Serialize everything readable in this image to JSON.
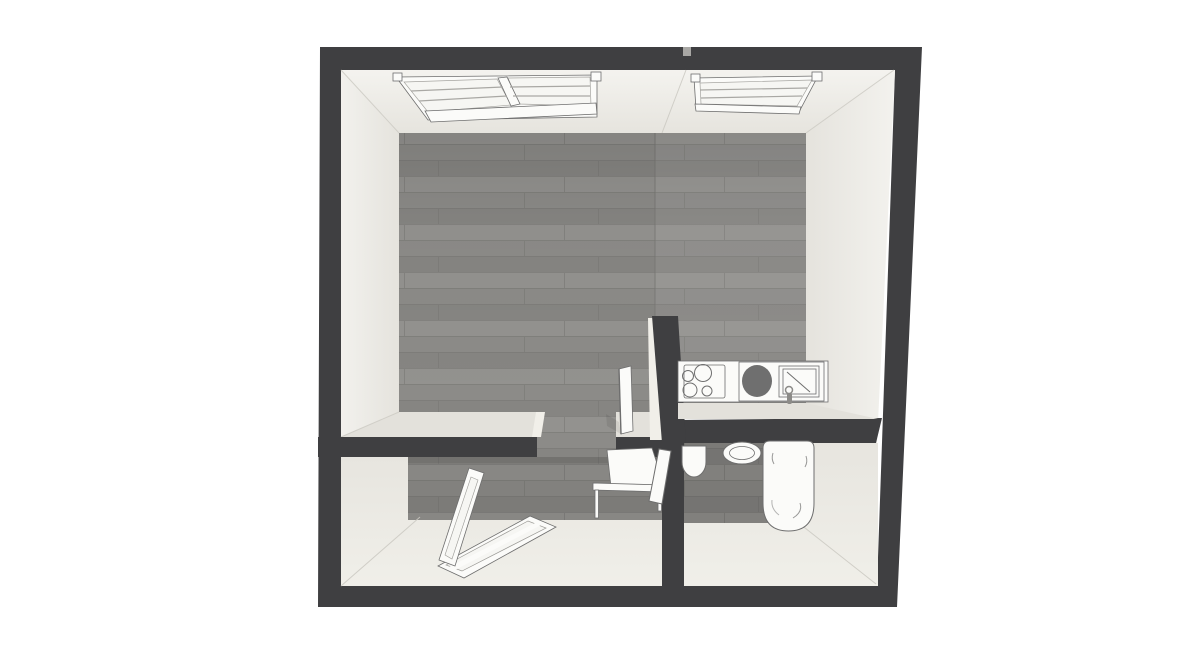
{
  "canvas": {
    "width": 1200,
    "height": 650,
    "view": "3d-floor-plan-top-down"
  },
  "page_background": "#ffffff",
  "colors": {
    "page_background": "#ffffff",
    "wall_top": "#3f3f41",
    "wall_face": "#f1efe9",
    "wall_face_shade": "#e3e1db",
    "floor_wood": "#8c8b88",
    "floor_wood_row2": "#868582",
    "floor_wood_row3": "#93928f",
    "plank_line": "#787774",
    "floor_soft": "#ecebe5",
    "fixture_fill": "#fbfbf9",
    "fixture_stroke": "#6e6e6e",
    "basin_fill": "#6f6f6f",
    "glass_fill": "#f6f6f3",
    "seam": "#cbc9c2",
    "notch": "#a8a7a4",
    "metal": "#8c8b88"
  },
  "scene": {
    "description_tag": "apartment-floorplan-render",
    "rooms": [
      {
        "name": "main-room",
        "floor": "wood-planks",
        "fixtures": [
          "roof-window-double",
          "roof-window-single",
          "interior-door-open"
        ]
      },
      {
        "name": "kitchen-nook",
        "floor": "wood-planks",
        "fixtures": [
          "kitchen-counter",
          "cooktop-4-burner",
          "kitchen-sink",
          "faucet"
        ]
      },
      {
        "name": "bottom-left-room",
        "floor": "wood-planks-partial",
        "fixtures": [
          "roof-window-open",
          "table",
          "bathroom-door-open"
        ]
      },
      {
        "name": "bathroom",
        "floor": "wood-planks-partial",
        "fixtures": [
          "toilet",
          "washbasin-round",
          "bathtub"
        ]
      }
    ]
  }
}
